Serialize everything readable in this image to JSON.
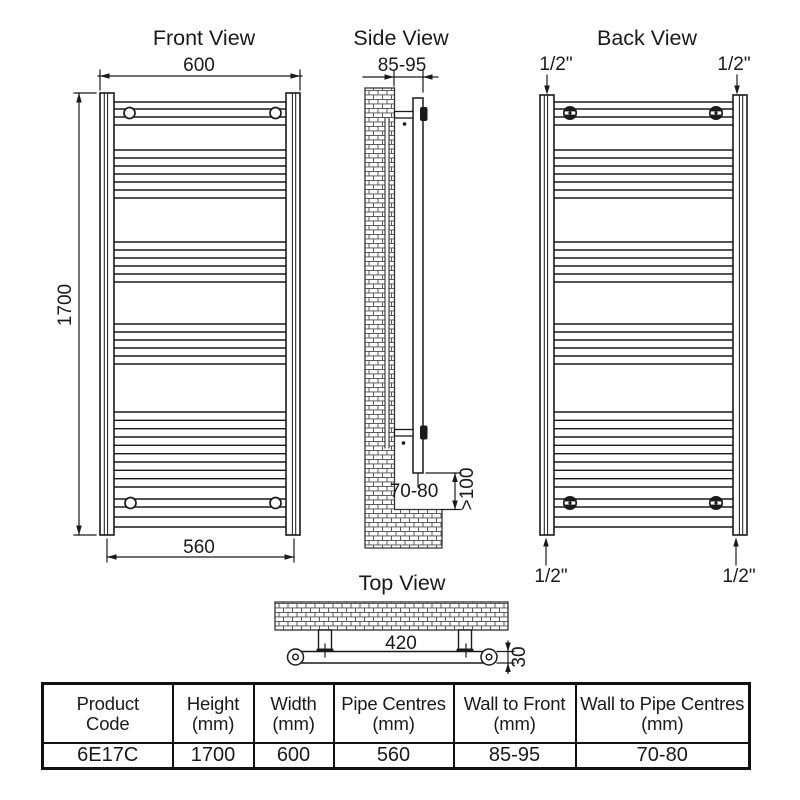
{
  "views": {
    "front": {
      "title": "Front View",
      "width_dim": "600",
      "height_dim": "1700",
      "pipe_centres_dim": "560"
    },
    "side": {
      "title": "Side View",
      "wall_to_front_dim": "85-95",
      "wall_to_pipe_dim": "70-80",
      "floor_clearance_dim": ">100"
    },
    "back": {
      "title": "Back View",
      "conn_top_left": "1/2\"",
      "conn_top_right": "1/2\"",
      "conn_bottom_left": "1/2\"",
      "conn_bottom_right": "1/2\""
    },
    "top": {
      "title": "Top View",
      "bracket_centres_dim": "420",
      "depth_dim": "30"
    }
  },
  "table": {
    "headers": [
      {
        "line1": "Product",
        "line2": "Code"
      },
      {
        "line1": "Height",
        "line2": "(mm)"
      },
      {
        "line1": "Width",
        "line2": "(mm)"
      },
      {
        "line1": "Pipe Centres",
        "line2": "(mm)"
      },
      {
        "line1": "Wall to Front",
        "line2": "(mm)"
      },
      {
        "line1": "Wall to Pipe Centres",
        "line2": "(mm)"
      }
    ],
    "values": [
      "6E17C",
      "1700",
      "600",
      "560",
      "85-95",
      "70-80"
    ]
  }
}
